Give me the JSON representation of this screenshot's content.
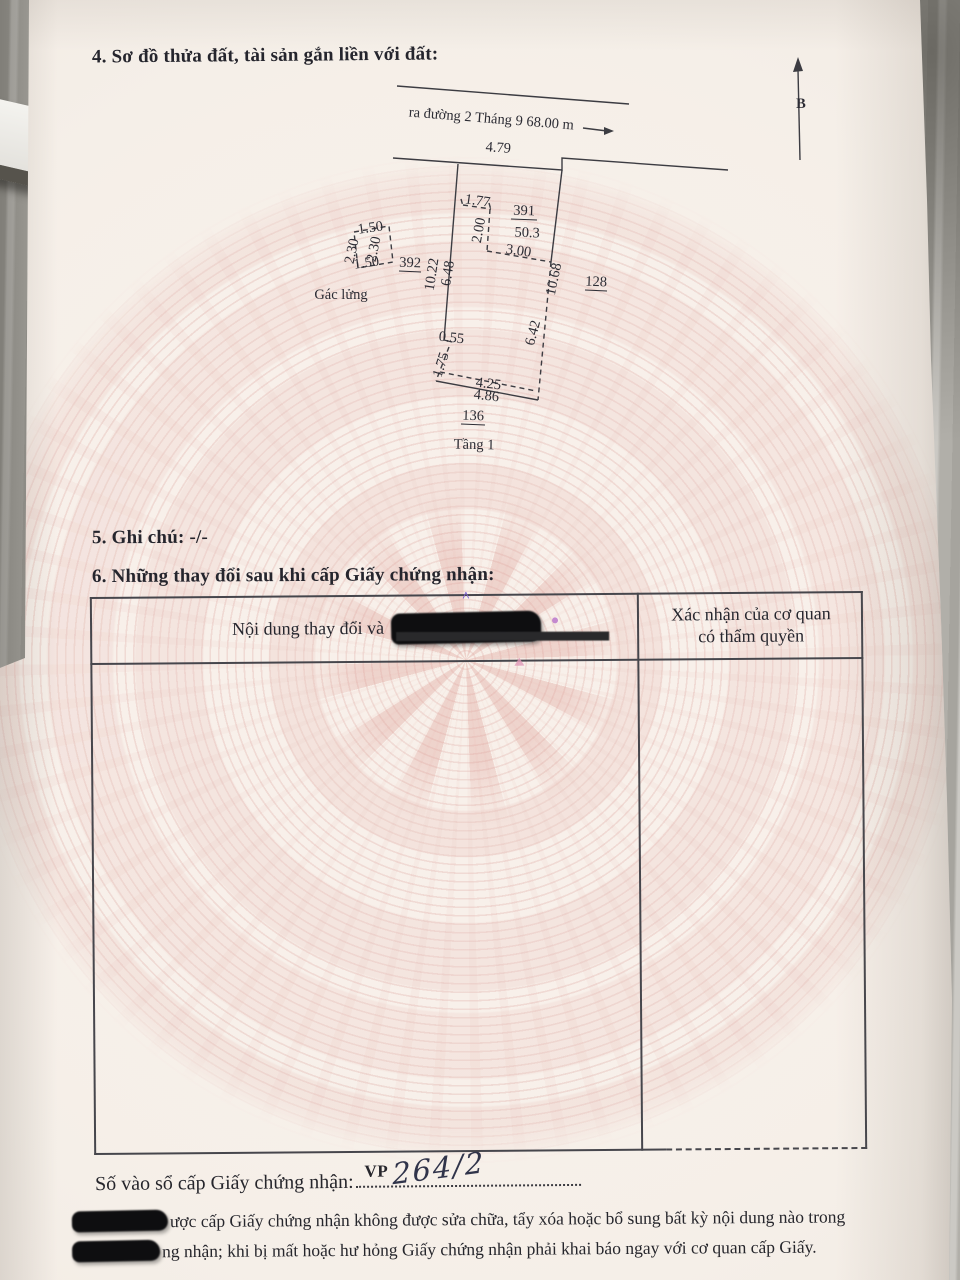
{
  "document": {
    "section4_title": "4. Sơ đồ thửa đất, tài sản gắn liền với đất:",
    "section5_title": "5. Ghi chú: -/-",
    "section6_title": "6. Những thay đổi sau khi cấp Giấy chứng nhận:"
  },
  "diagram": {
    "north_label": "B",
    "road_label": "ra đường 2 Tháng 9  68.00 m",
    "front_width": "4.79",
    "parcel_number": "391",
    "parcel_area": "50.3",
    "left_length_outer": "10.22",
    "left_length_inner": "6.48",
    "right_length": "10.68",
    "inner_top": "1.77",
    "inner_vertical": "2.00",
    "inner_cross": "3.00",
    "inner_right": "6.42",
    "step_dim": "0.55",
    "lower_left_dim": "1.75",
    "bottom_inner": "4.25",
    "bottom_width": "4.86",
    "neighbor_left": "392",
    "neighbor_right": "128",
    "neighbor_bottom": "136",
    "mezzanine_label": "Gác lửng",
    "mezzanine_top": "1.50",
    "mezzanine_left": "2.30",
    "mezzanine_right": "2.30",
    "mezzanine_bottom": "1.50",
    "floor_label": "Tầng 1"
  },
  "table": {
    "header_left": "Nội dung thay đổi và",
    "header_right_line1": "Xác nhận của cơ quan",
    "header_right_line2": "có thẩm quyền"
  },
  "footer": {
    "entry_label": "Số vào sổ cấp Giấy chứng nhận:",
    "entry_prefix": "VP",
    "entry_number": "264/2",
    "notice_line1": "ược cấp Giấy chứng nhận không được sửa chữa, tẩy xóa hoặc bổ sung bất kỳ nội dung nào trong",
    "notice_line2": "ng nhận; khi bị mất hoặc hư hỏng Giấy chứng nhận phải khai báo ngay với cơ quan cấp Giấy."
  },
  "colors": {
    "paper": "#f5efe8",
    "pattern_pink": "#ecd2cd",
    "ink": "#26262e",
    "redaction": "#0e0e10"
  }
}
